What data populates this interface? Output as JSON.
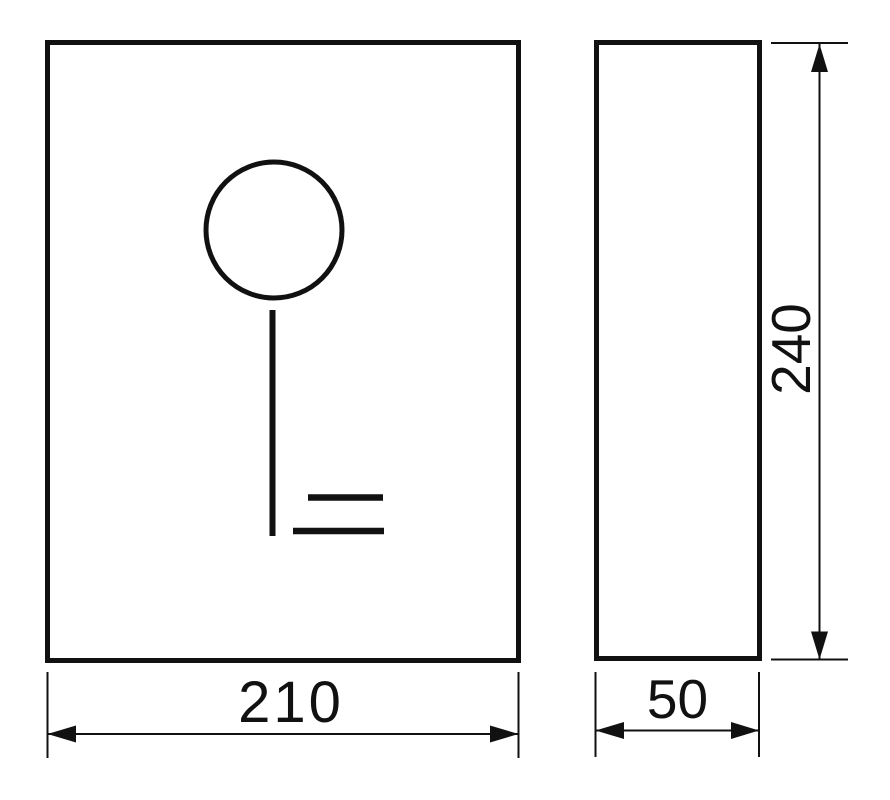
{
  "drawing": {
    "kind": "technical-dimension-drawing",
    "front_view": {
      "symbol": "key-icon"
    },
    "dimensions": {
      "front_width": "210",
      "side_width": "50",
      "side_height": "240"
    },
    "colors": {
      "line": "#111111",
      "background": "#ffffff"
    }
  }
}
